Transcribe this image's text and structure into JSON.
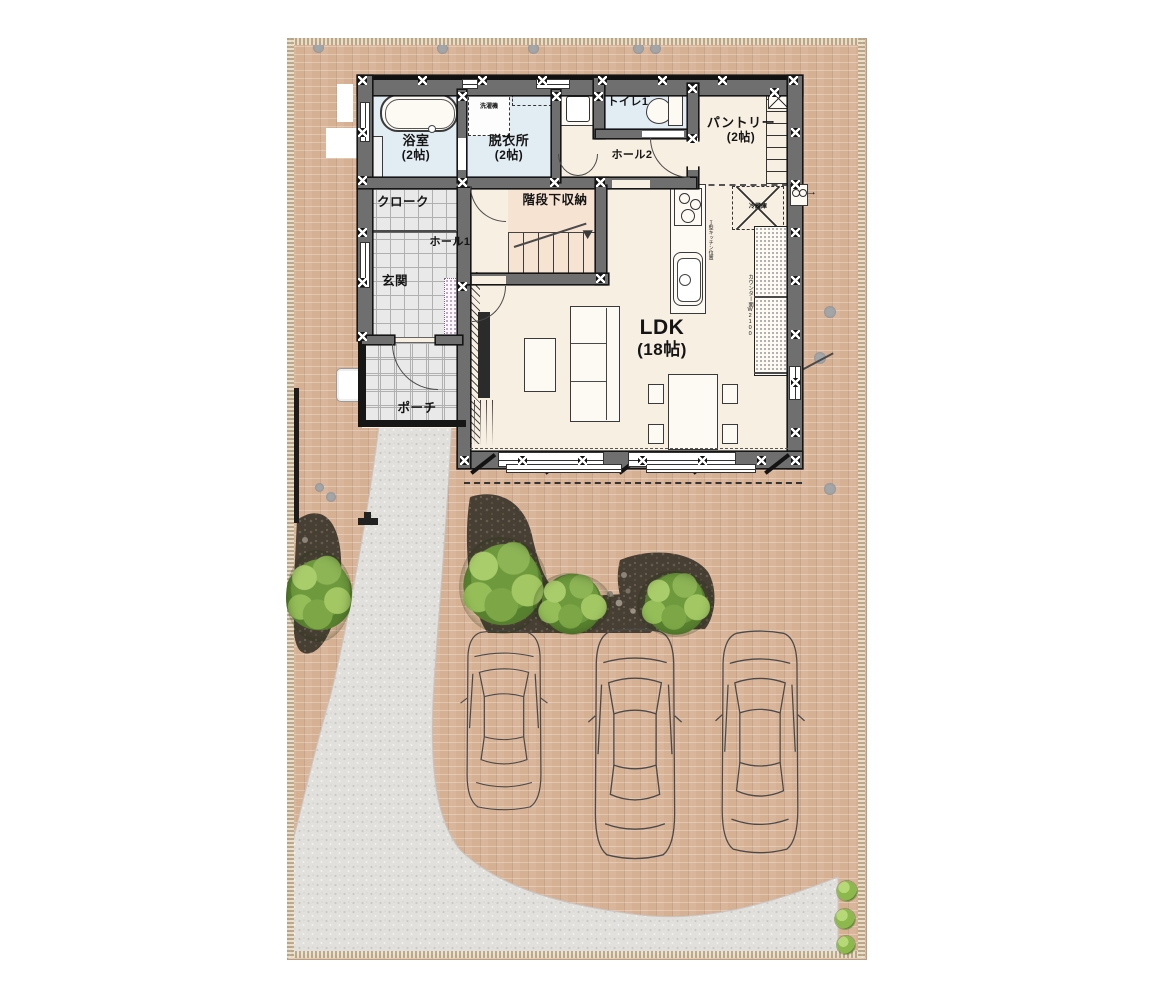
{
  "plan": {
    "rooms": {
      "bath": {
        "label": "浴室",
        "size": "(2帖)"
      },
      "dressing": {
        "label": "脱衣所",
        "size": "(2帖)"
      },
      "toilet": {
        "label": "トイレ1"
      },
      "hall2": {
        "label": "ホール2"
      },
      "pantry": {
        "label": "パントリー",
        "size": "(2帖)"
      },
      "understairs": {
        "label": "階段下収納"
      },
      "hall1": {
        "label": "ホール1"
      },
      "cloak": {
        "label": "クローク"
      },
      "genkan": {
        "label": "玄関"
      },
      "porch": {
        "label": "ポーチ"
      },
      "ldk": {
        "label": "LDK",
        "size": "(18帖)"
      }
    },
    "annotations": {
      "washer": "洗濯機",
      "fridge": "冷蔵庫",
      "counter": "カウンター面W2100",
      "kitchen_note": "Ｉ型キッチン位置",
      "heater_arrow": "→"
    }
  },
  "colors": {
    "ground_tan": "#d6b093",
    "driveway_gray": "#e2e0dd",
    "floor_cream": "#f7efe1",
    "wet_area_blue": "#e2ecf3",
    "stairs_peach": "#f7e3d2",
    "wall_gray": "#6f6f6f",
    "planting_bed": "#473f34",
    "tree_green": "#8db454"
  },
  "site": {
    "stepping_stones": [
      {
        "x": 313,
        "y": 42,
        "s": 11
      },
      {
        "x": 437,
        "y": 43,
        "s": 11
      },
      {
        "x": 528,
        "y": 43,
        "s": 11
      },
      {
        "x": 633,
        "y": 43,
        "s": 11
      },
      {
        "x": 650,
        "y": 43,
        "s": 11
      },
      {
        "x": 824,
        "y": 306,
        "s": 12
      },
      {
        "x": 814,
        "y": 352,
        "s": 12
      },
      {
        "x": 824,
        "y": 483,
        "s": 12
      },
      {
        "x": 315,
        "y": 483,
        "s": 9
      },
      {
        "x": 326,
        "y": 492,
        "s": 10
      }
    ],
    "trees": [
      {
        "x": 286,
        "y": 550,
        "w": 66,
        "h": 92
      },
      {
        "x": 459,
        "y": 537,
        "w": 88,
        "h": 97
      },
      {
        "x": 533,
        "y": 573,
        "w": 78,
        "h": 62
      },
      {
        "x": 637,
        "y": 571,
        "w": 77,
        "h": 66
      }
    ],
    "shrubs": [
      {
        "x": 837,
        "y": 881,
        "s": 20
      },
      {
        "x": 835,
        "y": 909,
        "s": 20
      },
      {
        "x": 837,
        "y": 936,
        "s": 18
      }
    ],
    "cars": [
      {
        "x": 463,
        "y": 628,
        "w": 82,
        "h": 186
      },
      {
        "x": 591,
        "y": 626,
        "w": 88,
        "h": 238
      },
      {
        "x": 718,
        "y": 628,
        "w": 84,
        "h": 230
      }
    ]
  },
  "decor": {
    "posts": [
      [
        358,
        76
      ],
      [
        418,
        76
      ],
      [
        478,
        76
      ],
      [
        538,
        76
      ],
      [
        598,
        76
      ],
      [
        658,
        76
      ],
      [
        718,
        76
      ],
      [
        789,
        76
      ],
      [
        358,
        128
      ],
      [
        358,
        176
      ],
      [
        358,
        228
      ],
      [
        358,
        278
      ],
      [
        358,
        332
      ],
      [
        791,
        128
      ],
      [
        791,
        180
      ],
      [
        791,
        228
      ],
      [
        791,
        276
      ],
      [
        791,
        330
      ],
      [
        791,
        378
      ],
      [
        791,
        428
      ],
      [
        791,
        456
      ],
      [
        460,
        456
      ],
      [
        518,
        456
      ],
      [
        578,
        456
      ],
      [
        638,
        456
      ],
      [
        698,
        456
      ],
      [
        757,
        456
      ],
      [
        458,
        178
      ],
      [
        550,
        178
      ],
      [
        596,
        178
      ],
      [
        688,
        84
      ],
      [
        688,
        134
      ],
      [
        596,
        274
      ],
      [
        458,
        282
      ],
      [
        458,
        92
      ],
      [
        552,
        92
      ],
      [
        594,
        92
      ],
      [
        770,
        88
      ]
    ],
    "ties": [
      [
        468,
        462
      ],
      [
        542,
        462
      ],
      [
        616,
        462
      ],
      [
        690,
        462
      ],
      [
        762,
        462
      ]
    ]
  }
}
